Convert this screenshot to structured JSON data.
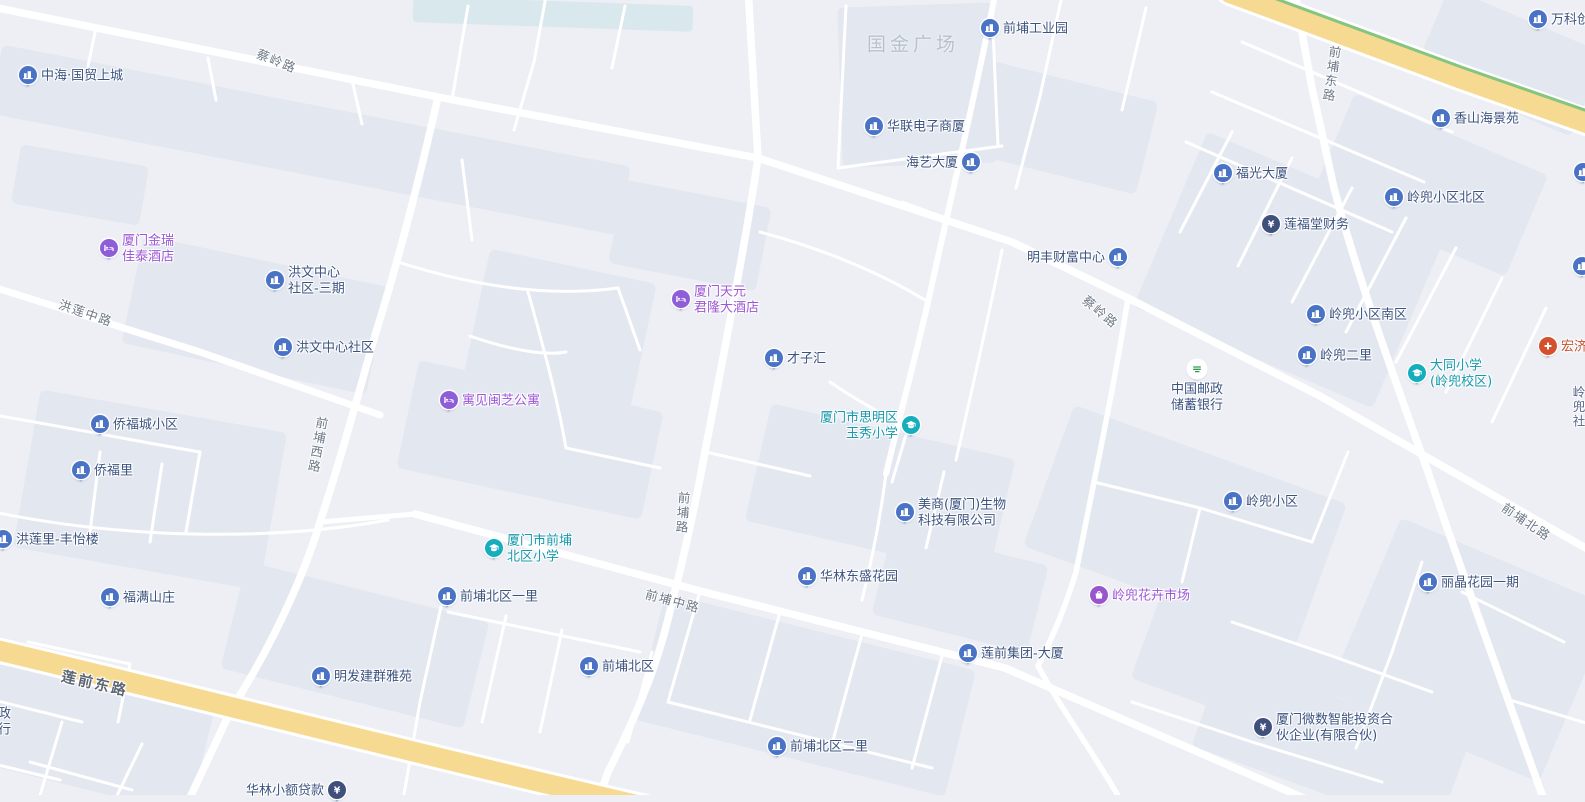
{
  "map": {
    "colors": {
      "background": "#edeff5",
      "block": "#e3e7f0",
      "block_teal": "#d9e8ec",
      "road": "#ffffff",
      "highway": "#f7da92",
      "highway_stripe": "#85c580",
      "pin": {
        "building": "#4a73c6",
        "hotel": "#8e5ed8",
        "school": "#16aebc",
        "finance": "#40507c",
        "market": "#9a55cc",
        "hospital": "#d5512e",
        "post": "#ffffff"
      },
      "text": {
        "building": "#3c5380",
        "hotel": "#9c57d4",
        "school": "#1599ab",
        "finance": "#3c5380",
        "market": "#9c57d4",
        "hospital": "#c2512e",
        "post": "#3c5380",
        "none": "#3c5380"
      }
    },
    "markers": [
      {
        "lines": [
          "中海·国贸上城"
        ],
        "x": 28,
        "y": 76,
        "icon": "building",
        "side": "right"
      },
      {
        "lines": [
          "前埔工业园"
        ],
        "x": 990,
        "y": 29,
        "icon": "building",
        "side": "right"
      },
      {
        "lines": [
          "万科创"
        ],
        "x": 1538,
        "y": 20,
        "icon": "building",
        "side": "right"
      },
      {
        "lines": [
          "华联电子商厦"
        ],
        "x": 874,
        "y": 127,
        "icon": "building",
        "side": "right"
      },
      {
        "lines": [
          "海艺大厦"
        ],
        "x": 971,
        "y": 163,
        "icon": "building",
        "side": "left"
      },
      {
        "lines": [
          "香山海景苑"
        ],
        "x": 1441,
        "y": 119,
        "icon": "building",
        "side": "right"
      },
      {
        "lines": [
          "福光大厦"
        ],
        "x": 1223,
        "y": 174,
        "icon": "building",
        "side": "right"
      },
      {
        "lines": [
          "岭兜小区北区"
        ],
        "x": 1394,
        "y": 198,
        "icon": "building",
        "side": "right"
      },
      {
        "lines": [],
        "x": 1583,
        "y": 173,
        "icon": "building",
        "side": "right"
      },
      {
        "lines": [
          "莲福堂财务"
        ],
        "x": 1271,
        "y": 225,
        "icon": "finance",
        "side": "right"
      },
      {
        "lines": [
          "厦门金瑞",
          "佳泰酒店"
        ],
        "x": 109,
        "y": 249,
        "icon": "hotel",
        "side": "right"
      },
      {
        "lines": [
          "明丰财富中心"
        ],
        "x": 1118,
        "y": 258,
        "icon": "building",
        "side": "left"
      },
      {
        "lines": [],
        "x": 1582,
        "y": 267,
        "icon": "building",
        "side": "right"
      },
      {
        "lines": [
          "洪文中心",
          "社区-三期"
        ],
        "x": 275,
        "y": 281,
        "icon": "building",
        "side": "right"
      },
      {
        "lines": [
          "厦门天元",
          "君隆大酒店"
        ],
        "x": 681,
        "y": 300,
        "icon": "hotel",
        "side": "right"
      },
      {
        "lines": [
          "洪文中心社区"
        ],
        "x": 283,
        "y": 348,
        "icon": "building",
        "side": "right"
      },
      {
        "lines": [
          "宏济"
        ],
        "x": 1548,
        "y": 347,
        "icon": "hospital",
        "side": "right"
      },
      {
        "lines": [
          "才子汇"
        ],
        "x": 774,
        "y": 359,
        "icon": "building",
        "side": "right"
      },
      {
        "lines": [
          "岭兜小区南区"
        ],
        "x": 1316,
        "y": 315,
        "icon": "building",
        "side": "right"
      },
      {
        "lines": [
          "岭兜二里"
        ],
        "x": 1307,
        "y": 356,
        "icon": "building",
        "side": "right"
      },
      {
        "lines": [
          "大同小学",
          "(岭兜校区)"
        ],
        "x": 1417,
        "y": 374,
        "icon": "school",
        "side": "right"
      },
      {
        "lines": [
          "中国邮政",
          "储蓄银行"
        ],
        "x": 1197,
        "y": 370,
        "icon": "post",
        "side": "below"
      },
      {
        "lines": [
          "寓见闽芝公寓"
        ],
        "x": 449,
        "y": 401,
        "icon": "hotel",
        "side": "right"
      },
      {
        "lines": [
          "厦门市思明区",
          "玉秀小学"
        ],
        "x": 911,
        "y": 426,
        "icon": "school",
        "side": "left"
      },
      {
        "lines": [
          "侨福城小区"
        ],
        "x": 100,
        "y": 425,
        "icon": "building",
        "side": "right"
      },
      {
        "lines": [
          "侨福里"
        ],
        "x": 81,
        "y": 471,
        "icon": "building",
        "side": "right"
      },
      {
        "lines": [
          "美商(厦门)生物",
          "科技有限公司"
        ],
        "x": 905,
        "y": 513,
        "icon": "building",
        "side": "right"
      },
      {
        "lines": [
          "岭兜小区"
        ],
        "x": 1233,
        "y": 502,
        "icon": "building",
        "side": "right"
      },
      {
        "lines": [
          "洪莲里-丰怡楼"
        ],
        "x": 3,
        "y": 540,
        "icon": "building",
        "side": "right"
      },
      {
        "lines": [
          "厦门市前埔",
          "北区小学"
        ],
        "x": 494,
        "y": 549,
        "icon": "school",
        "side": "right"
      },
      {
        "lines": [
          "华林东盛花园"
        ],
        "x": 807,
        "y": 577,
        "icon": "building",
        "side": "right"
      },
      {
        "lines": [
          "前埔北区一里"
        ],
        "x": 447,
        "y": 597,
        "icon": "building",
        "side": "right"
      },
      {
        "lines": [
          "丽晶花园一期"
        ],
        "x": 1428,
        "y": 583,
        "icon": "building",
        "side": "right"
      },
      {
        "lines": [
          "岭兜花卉市场"
        ],
        "x": 1099,
        "y": 596,
        "icon": "market",
        "side": "right"
      },
      {
        "lines": [
          "福满山庄"
        ],
        "x": 110,
        "y": 598,
        "icon": "building",
        "side": "right"
      },
      {
        "lines": [
          "莲前集团-大厦"
        ],
        "x": 968,
        "y": 654,
        "icon": "building",
        "side": "right"
      },
      {
        "lines": [
          "前埔北区"
        ],
        "x": 589,
        "y": 667,
        "icon": "building",
        "side": "right"
      },
      {
        "lines": [
          "明发建群雅苑"
        ],
        "x": 321,
        "y": 677,
        "icon": "building",
        "side": "right"
      },
      {
        "lines": [
          "厦门微数智能投资合",
          "伙企业(有限合伙)"
        ],
        "x": 1263,
        "y": 728,
        "icon": "finance",
        "side": "right"
      },
      {
        "lines": [
          "前埔北区二里"
        ],
        "x": 777,
        "y": 747,
        "icon": "building",
        "side": "right"
      },
      {
        "lines": [
          "华林小额贷款"
        ],
        "x": 337,
        "y": 791,
        "icon": "finance",
        "side": "left"
      },
      {
        "lines": [
          "邮政",
          "银行"
        ],
        "x": -15,
        "y": 722,
        "icon": "none",
        "side": "none"
      }
    ],
    "area_labels": [
      {
        "text": "国金广场",
        "x": 913,
        "y": 43
      }
    ],
    "road_labels": [
      {
        "text": "蔡岭路",
        "x": 277,
        "y": 60,
        "rot": 22
      },
      {
        "text": "前埔东路",
        "x": 1331,
        "y": 74,
        "rot": 8,
        "vertical": true
      },
      {
        "text": "蔡岭路",
        "x": 1101,
        "y": 311,
        "rot": 40
      },
      {
        "text": "洪莲中路",
        "x": 86,
        "y": 312,
        "rot": 19
      },
      {
        "text": "前埔西路",
        "x": 317,
        "y": 445,
        "rot": 10,
        "vertical": true
      },
      {
        "text": "前埔路",
        "x": 682,
        "y": 513,
        "rot": 4,
        "vertical": true
      },
      {
        "text": "前埔中路",
        "x": 673,
        "y": 600,
        "rot": 15
      },
      {
        "text": "前埔北路",
        "x": 1527,
        "y": 521,
        "rot": 34
      },
      {
        "text": "莲前东路",
        "x": 95,
        "y": 683,
        "rot": 13,
        "kind": "major"
      },
      {
        "text": "岭兜社",
        "x": 1578,
        "y": 407,
        "rot": 0,
        "vertical": true,
        "kind": "district"
      }
    ]
  }
}
